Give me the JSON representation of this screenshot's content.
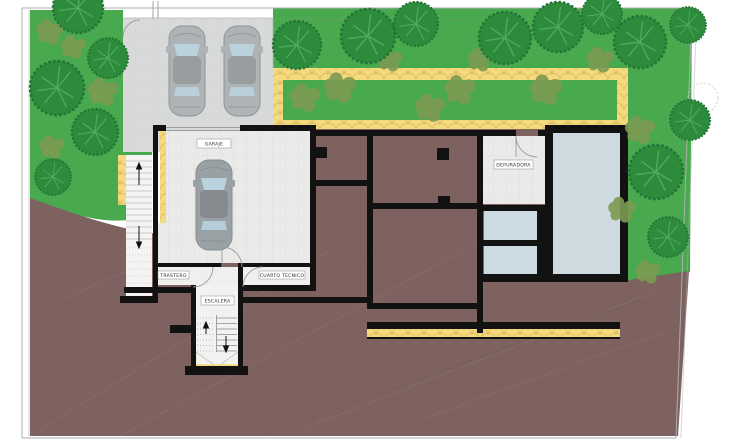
{
  "plan": {
    "room_labels": {
      "garage": "GARAJE",
      "storage": "TRASTERO",
      "technical_room": "CUARTO TECNICO",
      "staircase": "ESCALERA",
      "water_treatment": "DEPURADORA"
    },
    "vehicles": {
      "driveway_count": 2,
      "garage_count": 1
    },
    "colors": {
      "grass": "#48a94e",
      "tree": "#2d8c3c",
      "shrub": "#7d9a52",
      "earth": "#7d6260",
      "stone_path": "#f5d97d",
      "pool_water": "#cbdbe1",
      "walls": "#121212",
      "room_floor": "#eaeae8",
      "driveway": "#d8dad9"
    }
  }
}
